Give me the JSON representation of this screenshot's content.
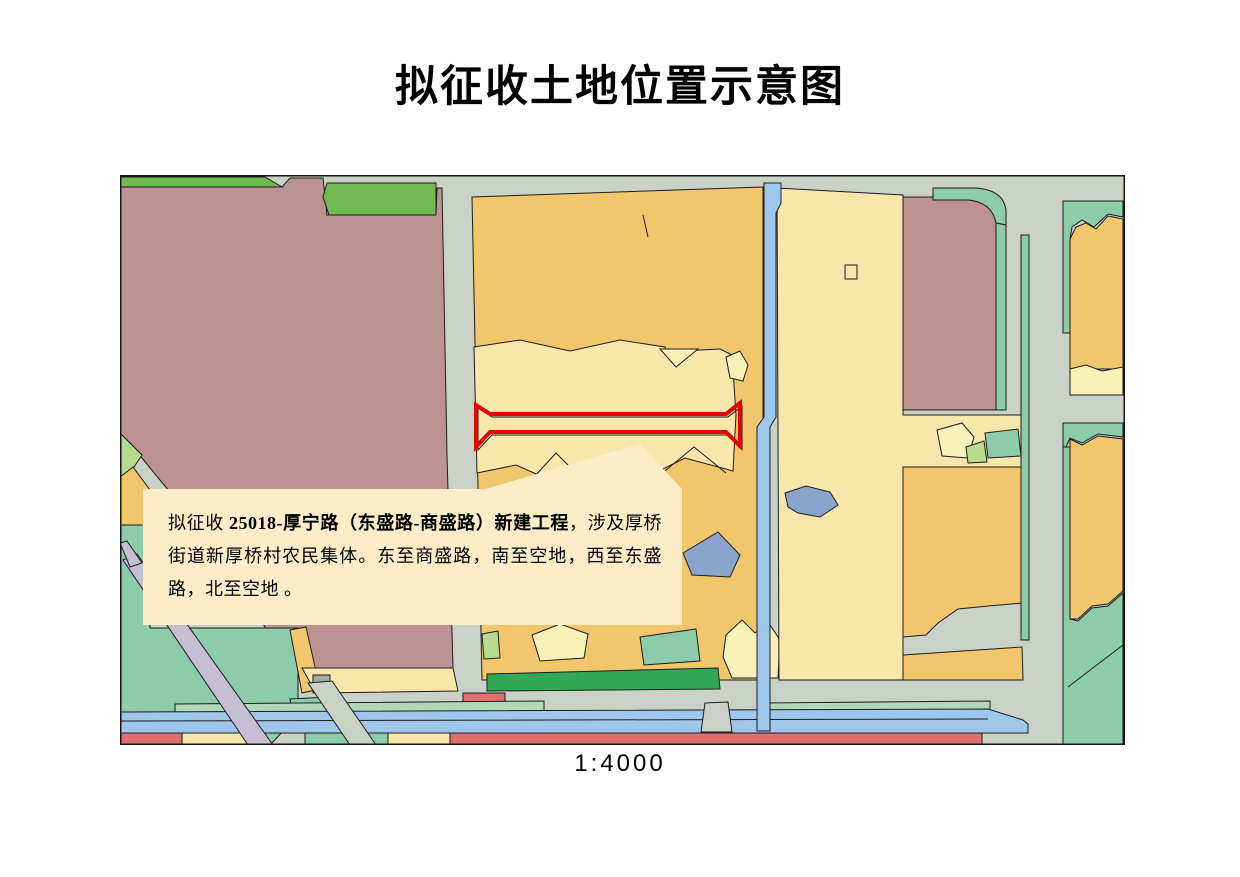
{
  "title": "拟征收土地位置示意图",
  "scale_label": "1:4000",
  "callout": {
    "text_prefix": "拟征收 ",
    "text_bold": "25018-厚宁路（东盛路-商盛路）新建工程",
    "text_suffix": "，涉及厚桥街道新厚桥村农民集体。东至商盛路，南至空地，西至东盛路，北至空地 。",
    "background": "#fcedc8"
  },
  "map": {
    "highlight_color": "#e60000",
    "palette": {
      "road_gray": "#cad1c7",
      "parcel_orange": "#f2c66b",
      "parcel_light_yellow": "#f9e6ab",
      "parcel_pale_yellow": "#f8f0b6",
      "parcel_mauve": "#bd9292",
      "parcel_green": "#6fba52",
      "parcel_teal": "#8dccaa",
      "parcel_light_teal": "#b2d8ba",
      "parcel_yellow_green": "#b8da8e",
      "parcel_dark_green": "#2fa857",
      "water_blue": "#9fc7ec",
      "water_slate": "#8ba4ce",
      "parcel_red": "#e0706e",
      "road_lavender": "#c6bed2"
    }
  }
}
